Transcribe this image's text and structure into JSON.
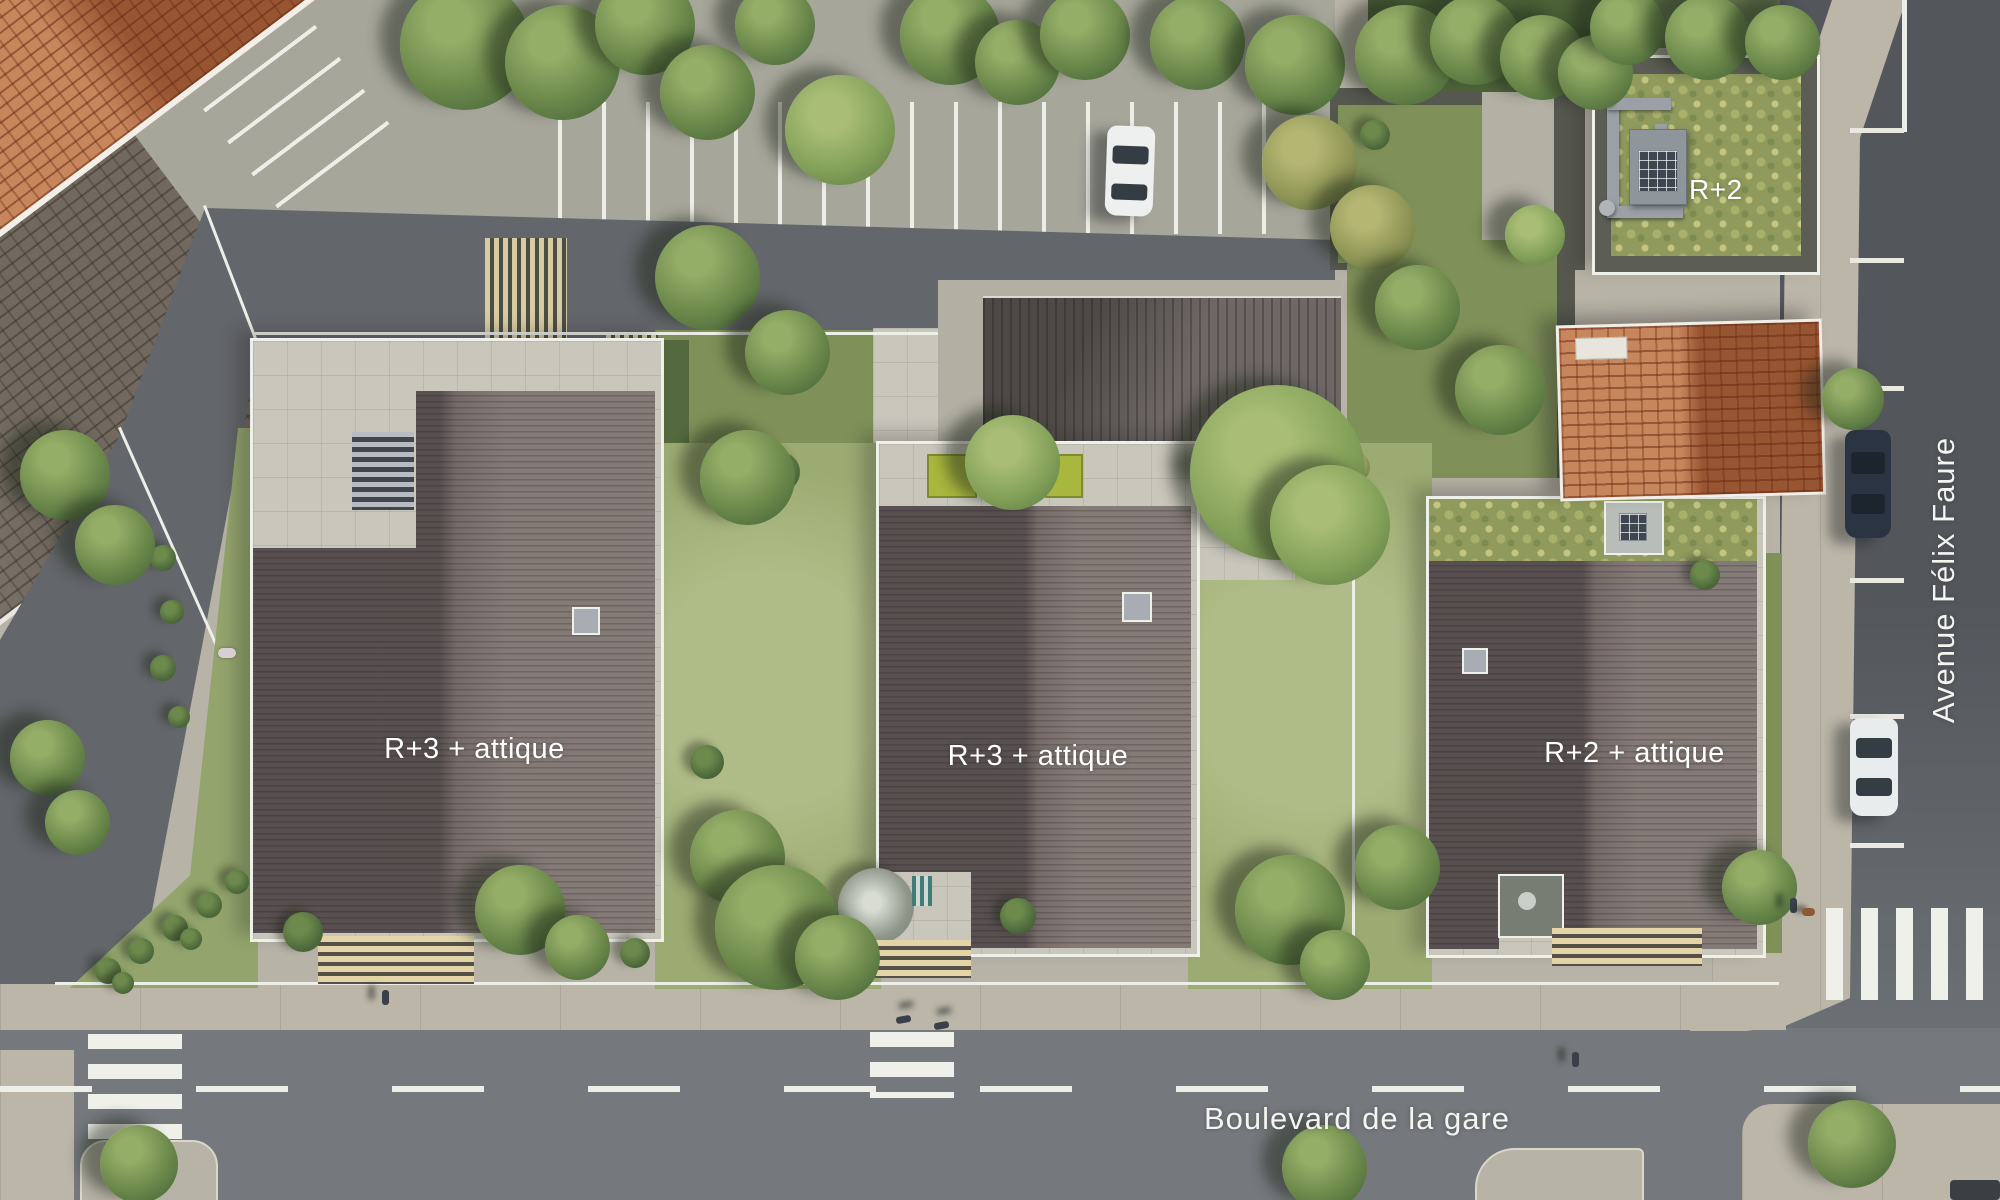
{
  "labels": {
    "building_west": "R+3 + attique",
    "building_center": "R+3 + attique",
    "building_east": "R+2 + attique",
    "building_northeast": "R+2",
    "street_east": "Avenue Félix Faure",
    "street_south": "Boulevard de la gare"
  },
  "colors": {
    "avenue_asphalt": "#53575c",
    "boulevard_asphalt": "#75797d",
    "sidewalk": "#bcb6a9",
    "parking_surface": "#a7a69b",
    "building_roof": "#6f6563",
    "red_tile_roof": "#b4693f",
    "lawn_green": "#9cab72",
    "sedum_roof_green": "#8f9a5c",
    "road_marking_white": "#f0f0ea"
  }
}
